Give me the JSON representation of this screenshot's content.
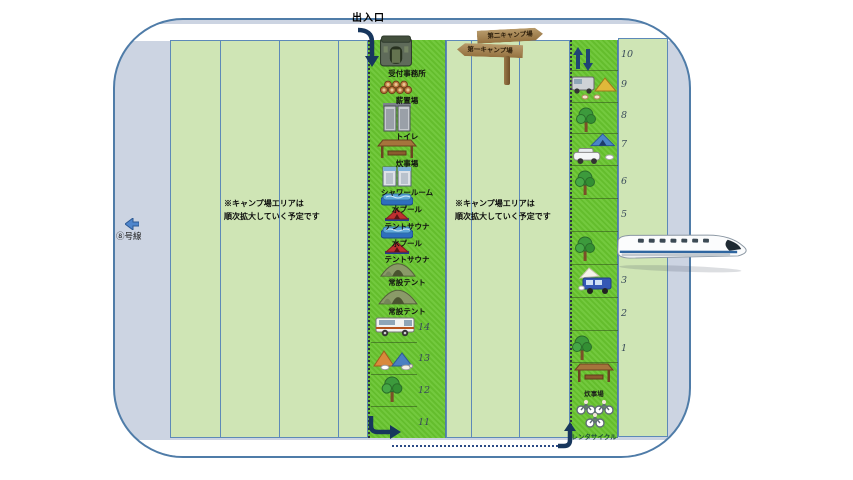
{
  "colors": {
    "map_background": "#ccd4e2",
    "map_border": "#4f7ca8",
    "panel_green": "#cfe5b5",
    "panel_border": "#5d89b8",
    "strip_green": "#68c52f",
    "path_navy": "#1f3a66",
    "sign_wood": "#a0824f"
  },
  "entrance": {
    "label": "出入口",
    "icon": "entrance-down-arrow-icon"
  },
  "route": {
    "label": "⑧号線",
    "icon": "left-arrow-icon"
  },
  "signpost": {
    "top_label": "第二キャンプ場",
    "bottom_label": "第一キャンプ場"
  },
  "notes": {
    "left": {
      "line1": "※キャンプ場エリアは",
      "line2": "順次拡大していく予定です"
    },
    "right": {
      "line1": "※キャンプ場エリアは",
      "line2": "順次拡大していく予定です"
    }
  },
  "central_strip": {
    "facilities": [
      {
        "label": "受付事務所",
        "icon": "reception-building-icon"
      },
      {
        "label": "薪置場",
        "icon": "firewood-logs-icon"
      },
      {
        "label": "トイレ",
        "icon": "toilet-icon"
      },
      {
        "label": "炊事場",
        "icon": "kitchen-shelter-icon"
      },
      {
        "label": "シャワールーム",
        "icon": "shower-rooms-icon"
      },
      {
        "label": "水プール",
        "icon": "pool-icon"
      },
      {
        "label": "テントサウナ",
        "icon": "sauna-tent-icon"
      },
      {
        "label": "水プール",
        "icon": "pool-icon"
      },
      {
        "label": "テントサウナ",
        "icon": "sauna-tent-icon"
      },
      {
        "label": "常設テント",
        "icon": "permanent-tent-icon"
      },
      {
        "label": "常設テント",
        "icon": "permanent-tent-icon"
      }
    ],
    "site_numbers": [
      "14",
      "13",
      "12",
      "11"
    ],
    "site_icons": {
      "14": "camper-van-icon",
      "13": "tents-with-dogs-icon",
      "12": "tree-icon"
    }
  },
  "right_strip": {
    "arrows_icon": "two-way-arrows-icon",
    "site_numbers": [
      "10",
      "9",
      "8",
      "7",
      "6",
      "5",
      "4",
      "3",
      "2",
      "1"
    ],
    "site_icons": {
      "9": "camper-and-tent-icon",
      "8": "tree-icon",
      "7": "tent-and-car-icon",
      "6": "tree-icon",
      "4": "tree-icon",
      "3": "van-icon",
      "1": "tree-icon"
    },
    "kitchen_label": "炊事場",
    "kitchen_icon": "kitchen-shelter-icon",
    "rental_label": "レンタサイクル",
    "rental_icon": "bicycles-icon"
  },
  "train": {
    "icon": "shinkansen-train-icon"
  }
}
